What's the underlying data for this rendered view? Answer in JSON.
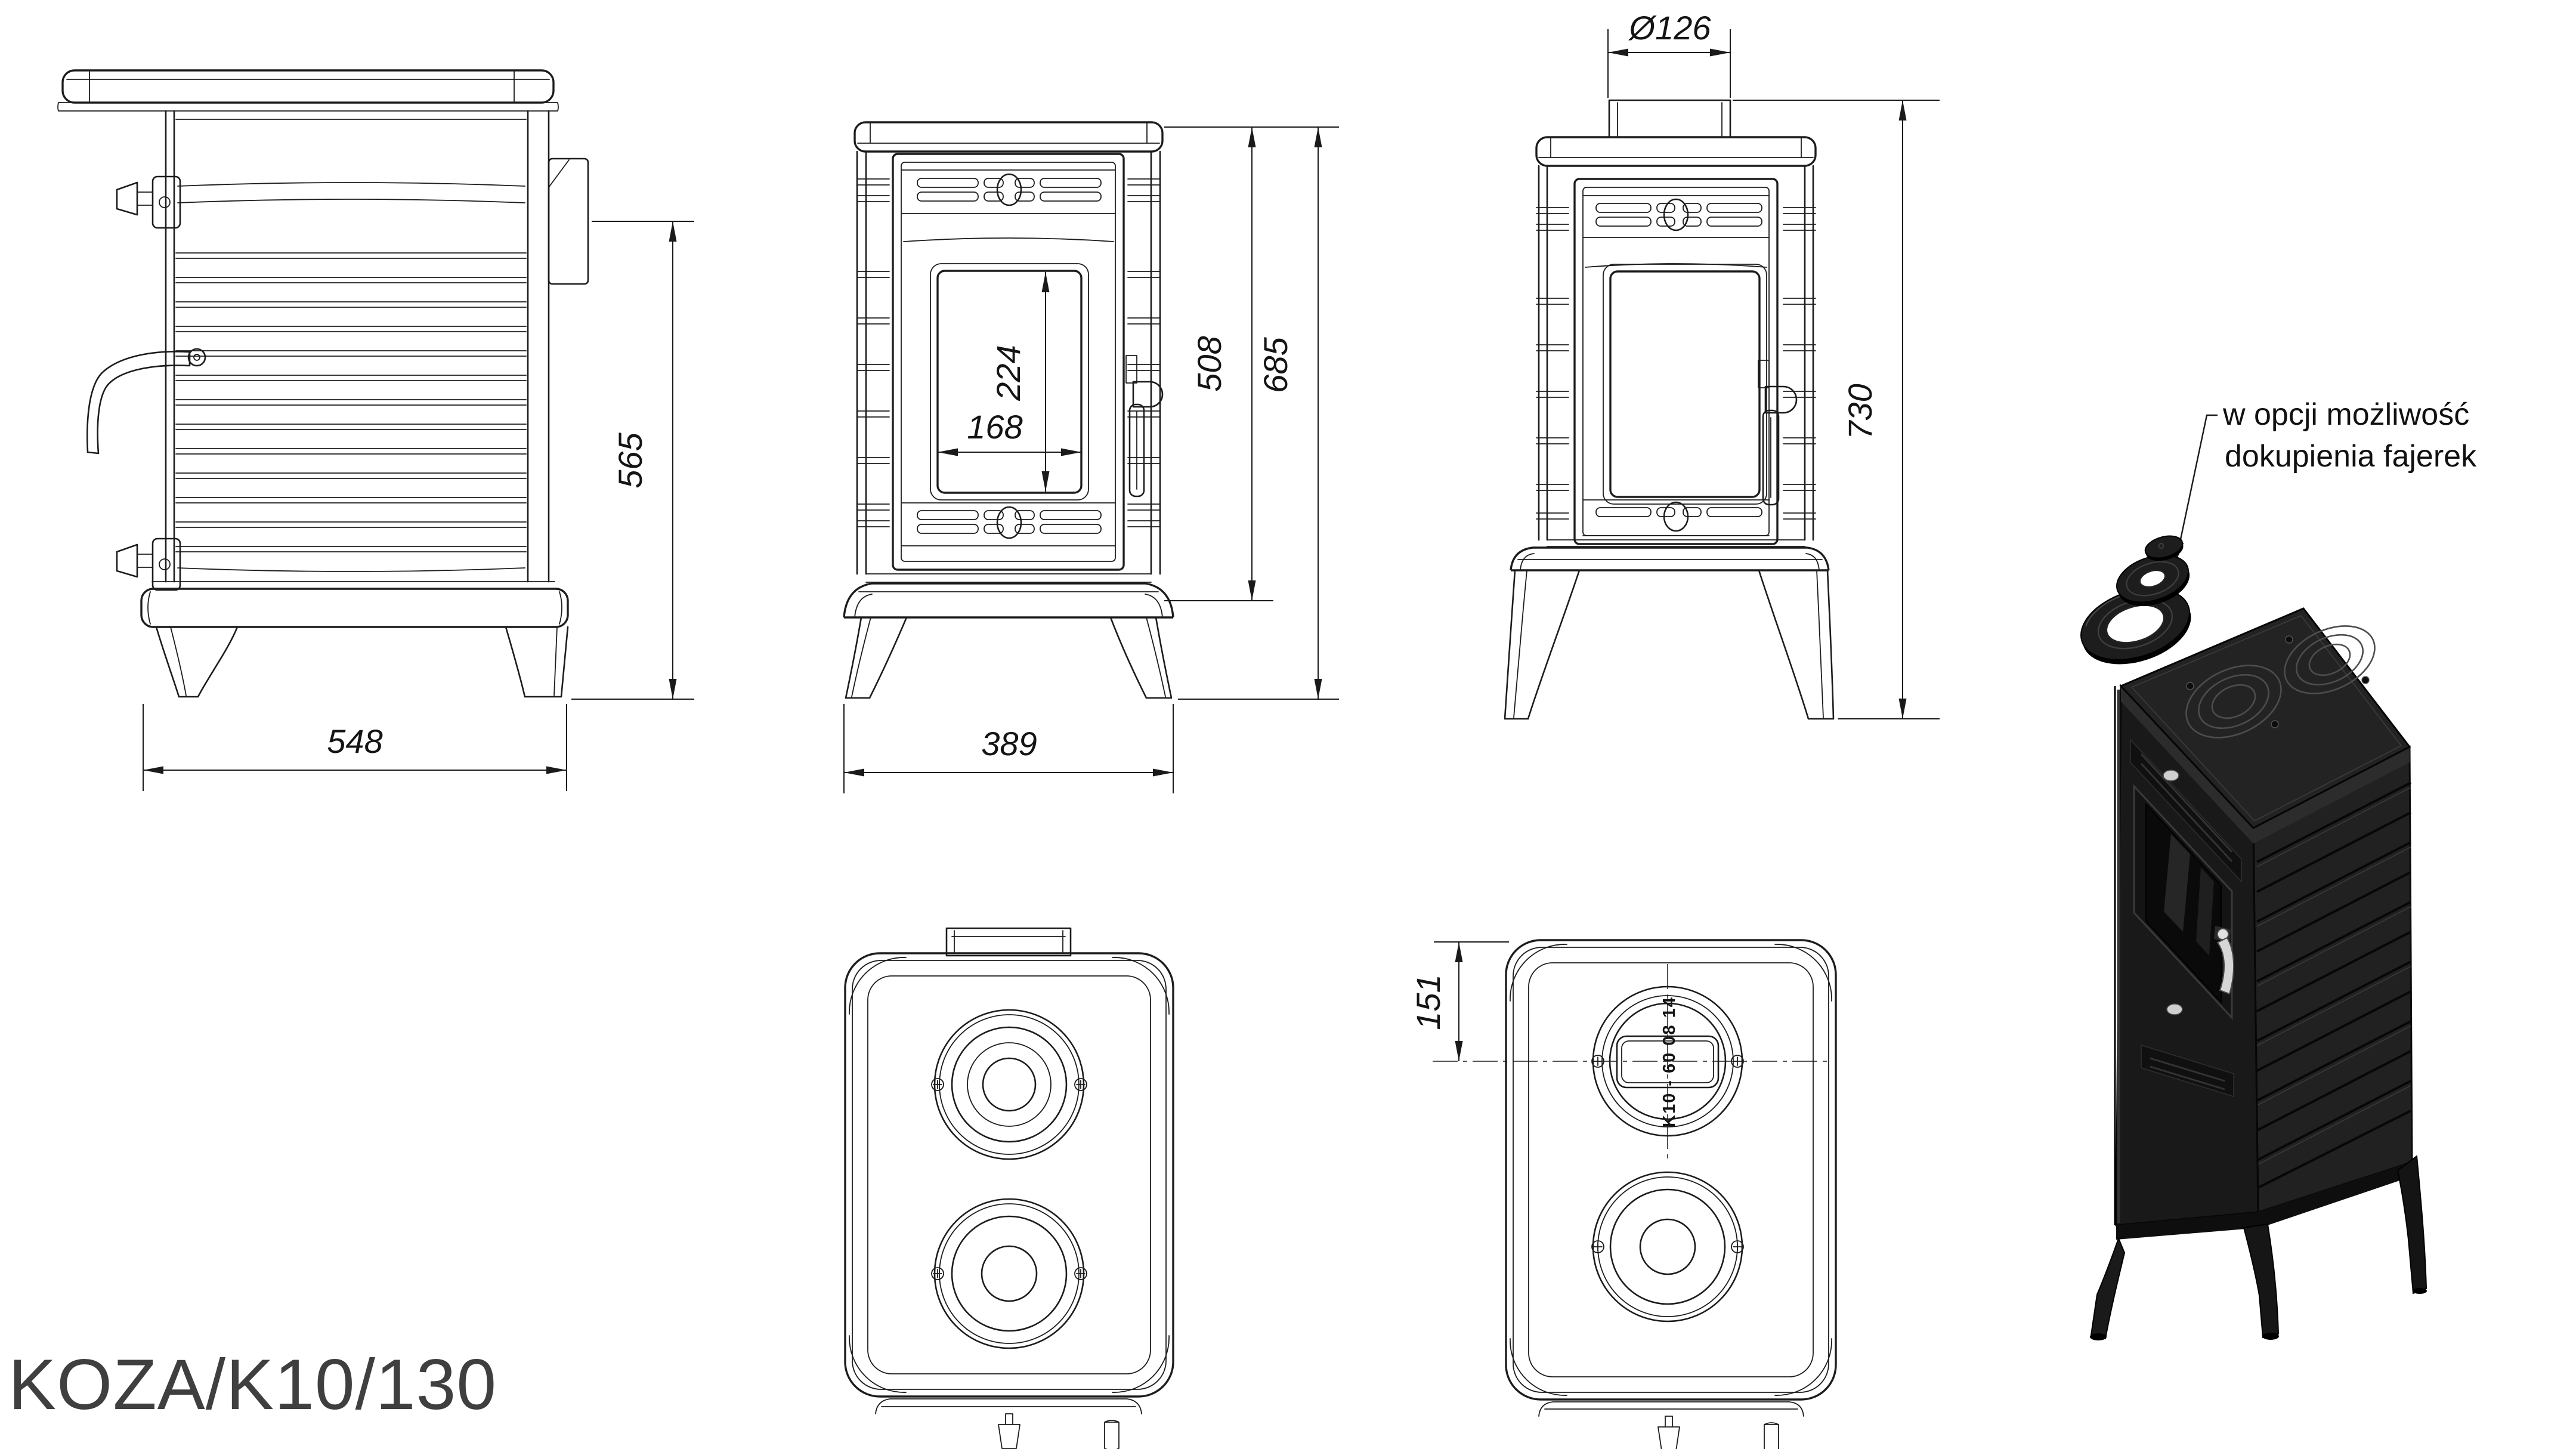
{
  "title": "KOZA/K10/130",
  "note": {
    "line1": "w opcji możliwość",
    "line2": "dokupienia fajerek"
  },
  "dims": {
    "side_width": "548",
    "side_height": "565",
    "glass_width": "168",
    "glass_height": "224",
    "body_height": "508",
    "total_height": "685",
    "front_width": "389",
    "flue_diameter": "Ø126",
    "height_with_flue": "730",
    "flue_center_offset": "151"
  },
  "casting_mark": "K10 - 60 08 14",
  "colors": {
    "line": "#1c1c1c",
    "title_text": "#3f3f3f",
    "stove_black": "#1b1b1b"
  }
}
